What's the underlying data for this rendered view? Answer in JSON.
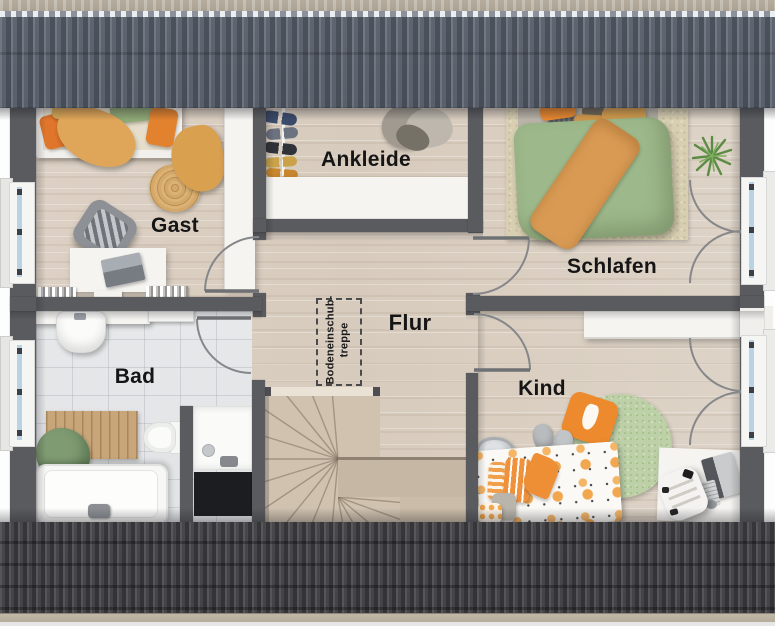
{
  "plan": {
    "type": "floor-plan",
    "rooms": {
      "gast": {
        "label": "Gast"
      },
      "ankleide": {
        "label": "Ankleide"
      },
      "schlafen": {
        "label": "Schlafen"
      },
      "flur": {
        "label": "Flur"
      },
      "bad": {
        "label": "Bad"
      },
      "kind": {
        "label": "Kind"
      }
    },
    "attic_hatch": {
      "line1": "Bodeneinschub-",
      "line2": "treppe"
    }
  },
  "colors": {
    "roof_top": "#5f6672",
    "roof_bottom": "#48484c",
    "ridge_cap": "#b6ad9e",
    "wall": "#595b5f",
    "floor_wood": "#d9cec0",
    "floor_tile": "#e3e5e7",
    "stair_wood": "#d0c2af",
    "accent_orange": "#e8882f",
    "duvet_green": "#9db88a",
    "rug_green": "#bdd0a8",
    "rug_beige": "#d8cfb2",
    "window_glass": "#b9d2e4",
    "label_text": "#151515"
  }
}
